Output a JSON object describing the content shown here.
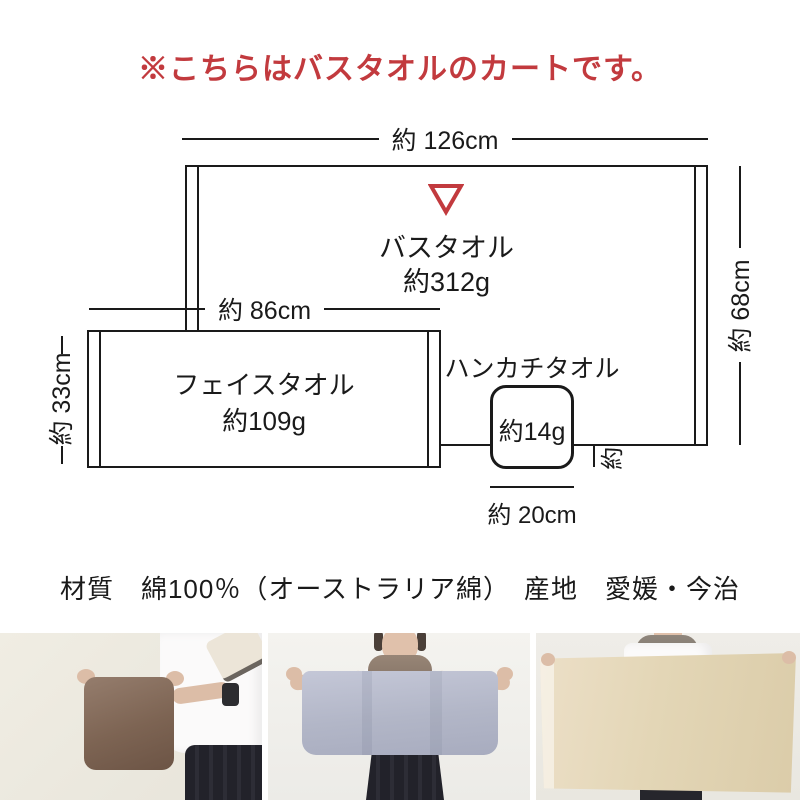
{
  "notice": {
    "text": "※こちらはバスタオルのカートです。",
    "color": "#c23a3e"
  },
  "diagram": {
    "bath_towel": {
      "label": "バスタオル",
      "weight": "約312g",
      "width": "約 126cm",
      "height": "約 68cm"
    },
    "face_towel": {
      "label": "フェイスタオル",
      "weight": "約109g",
      "width": "約 86cm",
      "height": "約 33cm"
    },
    "hand_towel": {
      "label": "ハンカチタオル",
      "weight": "約14g",
      "width": "約 20cm",
      "height": "約 20cm"
    },
    "pointer_icon": "red-triangle-down-outline",
    "line_color": "#1a1a1a",
    "accent_color": "#c23a3e"
  },
  "specs": {
    "text": "材質　綿100％（オーストラリア綿）　産地　愛媛・今治"
  },
  "photos": [
    {
      "name": "hand-towel-photo",
      "towel_color": "#7d6454"
    },
    {
      "name": "face-towel-photo",
      "towel_color": "#b4b8c9"
    },
    {
      "name": "bath-towel-photo",
      "towel_color": "#e3d6b6"
    }
  ]
}
